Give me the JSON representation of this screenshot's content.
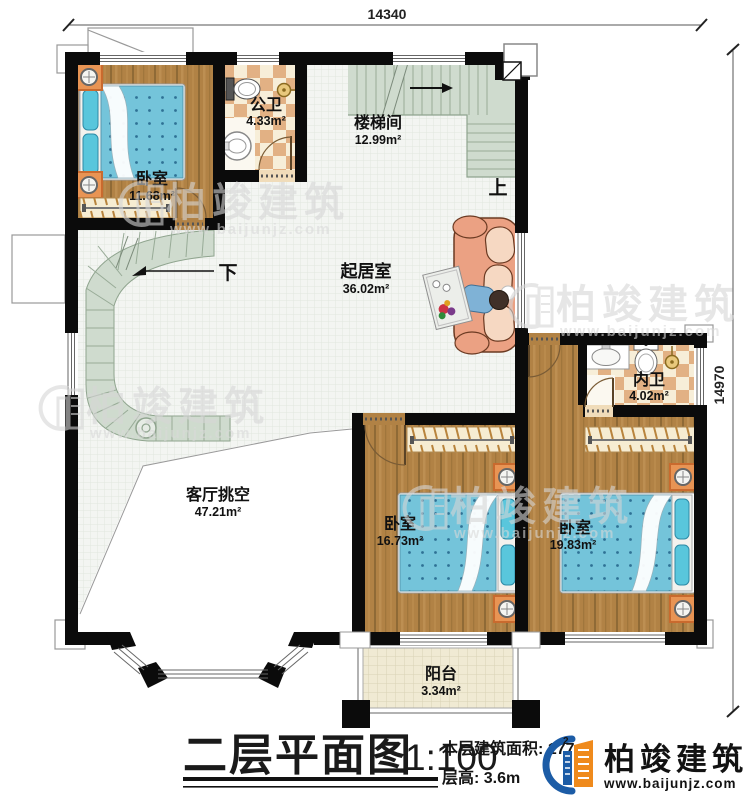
{
  "plan": {
    "title": "二层平面图",
    "scale": "1:100",
    "area_line": "本层建筑面积: 177.",
    "area_sup": "2",
    "floor_height_line": "层高: 3.6m",
    "dim_top": "14340",
    "dim_right": "14970",
    "stair_up": "上",
    "stair_down": "下"
  },
  "rooms": [
    {
      "name": "卧室",
      "area": "11.68m²"
    },
    {
      "name": "公卫",
      "area": "4.33m²"
    },
    {
      "name": "楼梯间",
      "area": "12.99m²"
    },
    {
      "name": "起居室",
      "area": "36.02m²"
    },
    {
      "name": "内卫",
      "area": "4.02m²"
    },
    {
      "name": "客厅挑空",
      "area": "47.21m²"
    },
    {
      "name": "卧室",
      "area": "16.73m²"
    },
    {
      "name": "卧室",
      "area": "19.83m²"
    },
    {
      "name": "阳台",
      "area": "3.34m²"
    }
  ],
  "brand": {
    "name": "柏竣建筑",
    "website": "www.baijunjz.com"
  },
  "watermark": {
    "name": "柏竣建筑",
    "website": "www.baijunjz.com"
  },
  "colors": {
    "wall": "#0b0b0b",
    "wood": "#b18245",
    "tile_light": "#f7eed8",
    "tile_dark": "#e2b184",
    "stair_green": "#cfdbce",
    "bed_blue": "#74c4da",
    "sofa": "#eba183",
    "logo_blue": "#1c5ca6",
    "logo_orange": "#ef8a1c"
  }
}
